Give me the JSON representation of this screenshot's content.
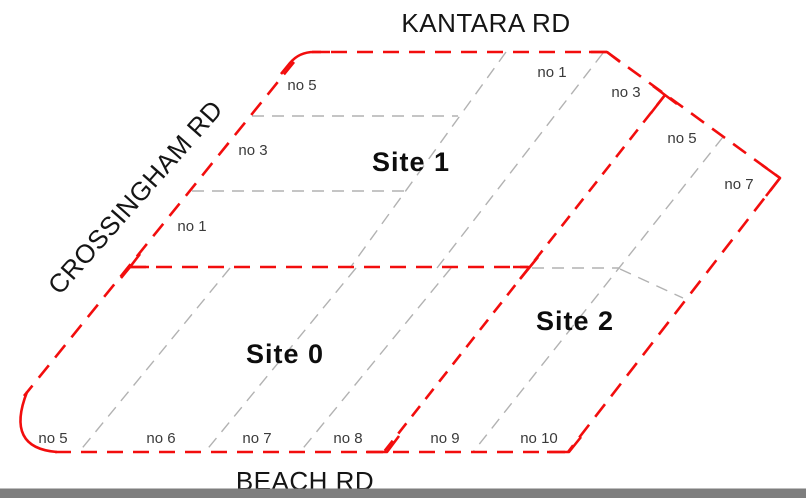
{
  "canvas": {
    "width": 806,
    "height": 498,
    "background": "#ffffff"
  },
  "colors": {
    "boundary_red": "#f20d0d",
    "lot_line_gray": "#b2b2b2",
    "road_text": "#151515",
    "site_text": "#0d0d0d",
    "lot_text": "#3a3a3a",
    "bottom_bar_gray": "#7e7e7e"
  },
  "roads": {
    "kantara": {
      "label": "KANTARA RD",
      "x": 486,
      "y": 32
    },
    "crossingham": {
      "label": "CROSSINGHAM RD",
      "transform": "translate(142,203) rotate(-48.5)"
    },
    "beach": {
      "label": "BEACH RD",
      "x": 305,
      "y": 490
    }
  },
  "sites": {
    "site0": {
      "label": "Site 0",
      "x": 285,
      "y": 363
    },
    "site1": {
      "label": "Site 1",
      "x": 411,
      "y": 171
    },
    "site2": {
      "label": "Site 2",
      "x": 575,
      "y": 330
    }
  },
  "lots": {
    "crossingham_frontage": [
      {
        "label": "no 5",
        "x": 302,
        "y": 90
      },
      {
        "label": "no 3",
        "x": 253,
        "y": 155
      },
      {
        "label": "no 1",
        "x": 192,
        "y": 231
      }
    ],
    "kantara_frontage": [
      {
        "label": "no 1",
        "x": 552,
        "y": 77
      },
      {
        "label": "no 3",
        "x": 626,
        "y": 97
      },
      {
        "label": "no 5",
        "x": 682,
        "y": 143
      },
      {
        "label": "no 7",
        "x": 739,
        "y": 189
      }
    ],
    "beach_frontage": [
      {
        "label": "no 5",
        "x": 53,
        "y": 443
      },
      {
        "label": "no 6",
        "x": 161,
        "y": 443
      },
      {
        "label": "no 7",
        "x": 257,
        "y": 443
      },
      {
        "label": "no 8",
        "x": 348,
        "y": 443
      },
      {
        "label": "no 9",
        "x": 445,
        "y": 443
      },
      {
        "label": "no 10",
        "x": 539,
        "y": 443
      }
    ]
  },
  "geometry": {
    "red": {
      "top_edge": "M 607 52 L 312 52",
      "topright_edge": "M 607 52 L 780 178",
      "right_edge": "M 780 178 L 568 452",
      "bottom_edge": "M 55 452 L 568 452",
      "left_edge": "M 294 62 L 24 396",
      "mid_line": "M 130 267 L 528 267",
      "divider": "M 665 95 L 383 453",
      "corner_topleft": "M 330 52 L 314 52 Q 299 52 290 63 L 281 74",
      "corner_topright": "M 589 52 L 607 52 L 620 62",
      "corner_right": "M 762 165 L 780 178 L 766 196",
      "corner_bottomright": "M 547 452 L 569 452 L 581 437",
      "corner_bottomleft": "M 27 392 Q 5 448 57 452",
      "junction_x": "M 653 86 L 677 104 M 665 95 L 651 113",
      "junction_mid_left": "M 140 254 L 130 267 L 149 267 M 130 267 L 121 278",
      "junction_mid_right": "M 513 267 L 529 267 M 538 257 L 520 279",
      "junction_bottom": "M 366 452 L 387 452 L 399 436"
    },
    "gray": {
      "h1": "M 252 116 L 458 116",
      "h2": "M 192 191 L 406 191",
      "l1": "M 506 52 L 350 268",
      "l2": "M 603 53 L 437 268",
      "d1": "M 230 268 L 79 452",
      "d2": "M 356 268 L 205 452",
      "d3": "M 451 268 L 300 452",
      "g_long": "M 723 137 L 473 452",
      "s2_h": "M 532 268 L 620 268",
      "s2_r": "M 620 269 L 683 298"
    },
    "bottom_bar": {
      "x": 0,
      "y": 488.5,
      "width": 806,
      "height": 9.5
    }
  }
}
